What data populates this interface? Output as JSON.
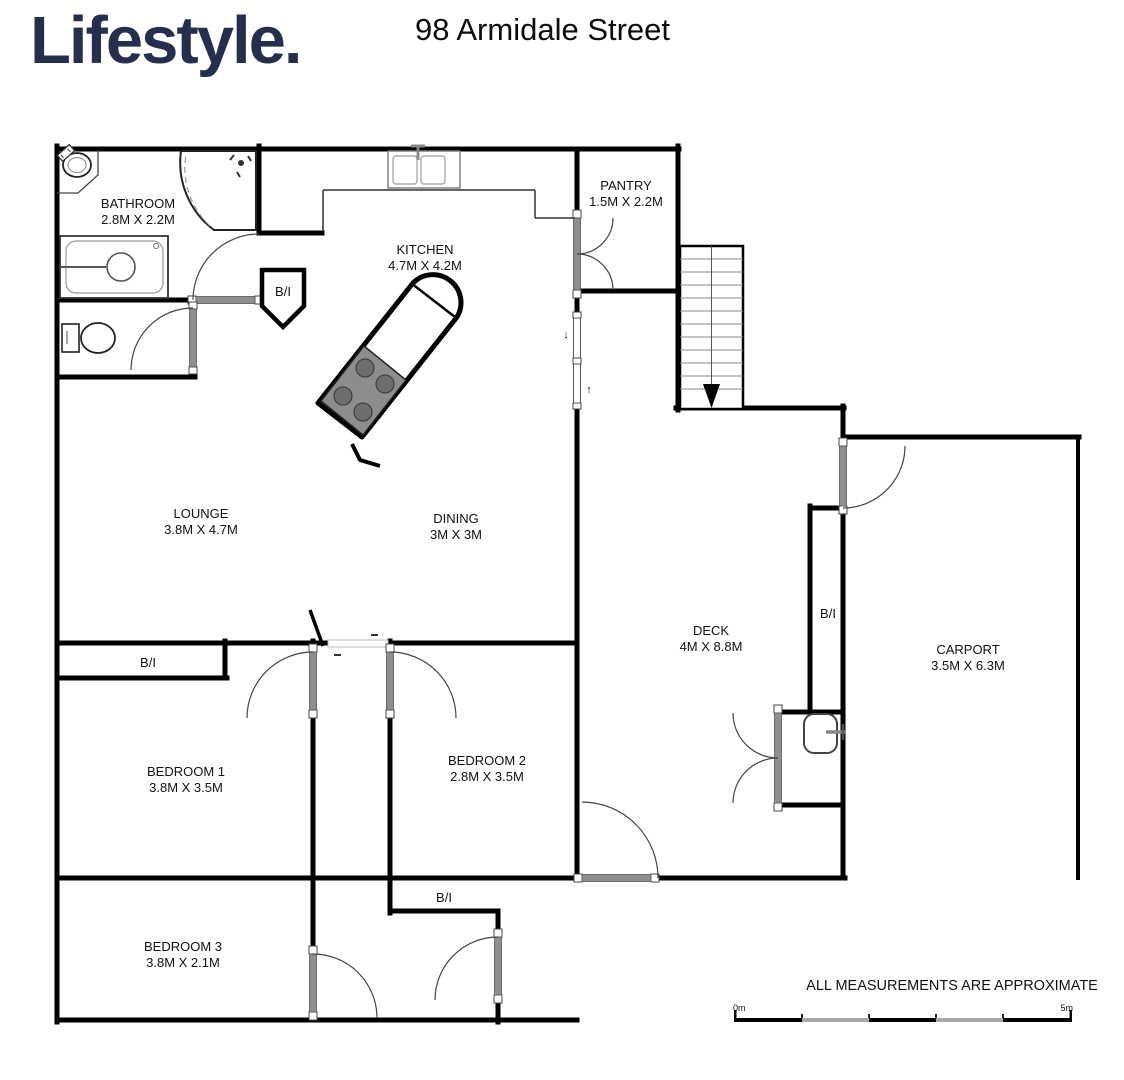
{
  "header": {
    "logo": "Lifestyle.",
    "title": "98 Armidale Street"
  },
  "colors": {
    "logo": "#252f4d",
    "wall": "#000000",
    "door_rail": "#8f8f8f"
  },
  "rooms": {
    "bathroom": {
      "name": "BATHROOM",
      "dims": "2.8M X 2.2M"
    },
    "kitchen": {
      "name": "KITCHEN",
      "dims": "4.7M X 4.2M"
    },
    "pantry": {
      "name": "PANTRY",
      "dims": "1.5M X 2.2M"
    },
    "lounge": {
      "name": "LOUNGE",
      "dims": "3.8M X 4.7M"
    },
    "dining": {
      "name": "DINING",
      "dims": "3M X 3M"
    },
    "deck": {
      "name": "DECK",
      "dims": "4M X 8.8M"
    },
    "carport": {
      "name": "CARPORT",
      "dims": "3.5M X 6.3M"
    },
    "bedroom1": {
      "name": "BEDROOM 1",
      "dims": "3.8M X 3.5M"
    },
    "bedroom2": {
      "name": "BEDROOM 2",
      "dims": "2.8M X 3.5M"
    },
    "bedroom3": {
      "name": "BEDROOM 3",
      "dims": "3.8M X 2.1M"
    }
  },
  "labels": {
    "builtin": "B/I"
  },
  "annotations": {
    "down_arrow": "↓",
    "up_arrow": "↑"
  },
  "footer": {
    "disclaimer": "ALL MEASUREMENTS ARE APPROXIMATE",
    "scale_start": "0m",
    "scale_end": "5m"
  }
}
